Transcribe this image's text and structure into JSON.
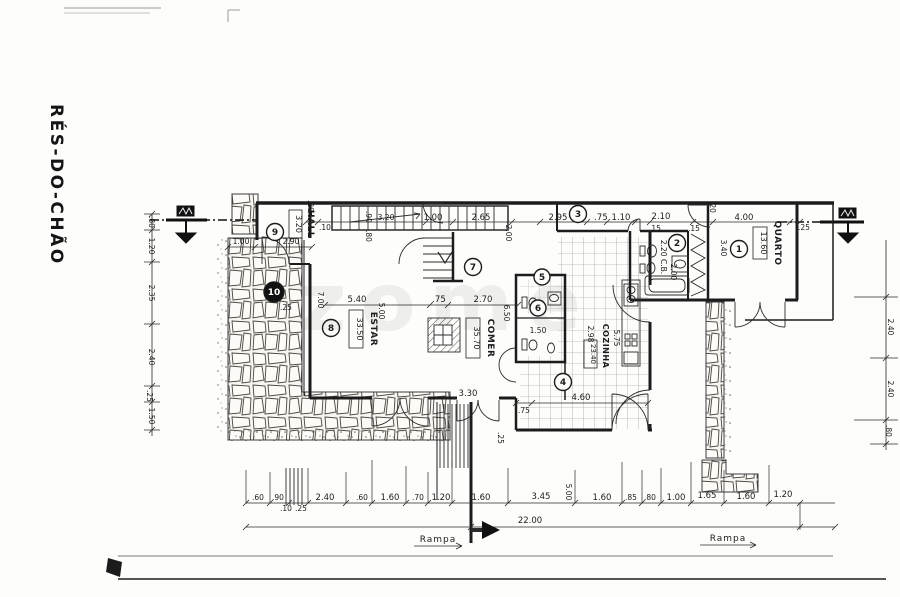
{
  "title": "RÉS-DO-CHÃO",
  "watermark": "zome",
  "labels": {
    "ramp": "Rampa"
  },
  "rooms": {
    "hall": {
      "name": "HALL",
      "area": "3.20"
    },
    "estar": {
      "name": "ESTAR",
      "area": "33.50"
    },
    "comer": {
      "name": "COMER",
      "area": "35.70"
    },
    "cozinha": {
      "name": "COZINHA",
      "area": "23.40"
    },
    "quarto": {
      "name": "QUARTO",
      "area": "13.60"
    },
    "banho": {
      "label": "2.20 C.B.",
      "depth": "2.00"
    }
  },
  "markers": [
    "1",
    "2",
    "3",
    "4",
    "5",
    "6",
    "7",
    "8",
    "9",
    "10"
  ],
  "dims": {
    "top": [
      ".20",
      ".10",
      ".90",
      ".80",
      "3.20",
      "1.00",
      "2.65",
      "2.00",
      "2.95",
      ".75",
      "1.10",
      ".15",
      "2.10",
      ".15",
      ".20",
      "4.00",
      ".25"
    ],
    "left": [
      ".80",
      "1.20",
      "2.35",
      "2.40",
      ".25",
      "1.50"
    ],
    "right": [
      "2.40",
      "2.40",
      ".80"
    ],
    "bottom": [
      ".60",
      ".90",
      ".10",
      ".25",
      "2.40",
      ".60",
      "1.60",
      ".70",
      "1.20",
      "1.60",
      "3.45",
      "5.00",
      "1.60",
      ".85",
      ".80",
      "1.00",
      "1.65",
      "1.60",
      "1.20"
    ],
    "total": "22.00",
    "interior": {
      "hall_w": "2.90",
      "hall_d": "1.00",
      "wall": ".25",
      "estar_h": "7.00",
      "estar_w": "5.40",
      "estar_d": "5.00",
      "pass": ".75",
      "comer_w": "2.70",
      "comer_h": "6.50",
      "entry": "3.30",
      "entry_t": ".25",
      "lobby": ".75",
      "kitchen_w": "4.60",
      "wc": "1.50",
      "koz_h": "5.75",
      "koz_d": "2.98",
      "quarto_d": "3.40"
    }
  }
}
